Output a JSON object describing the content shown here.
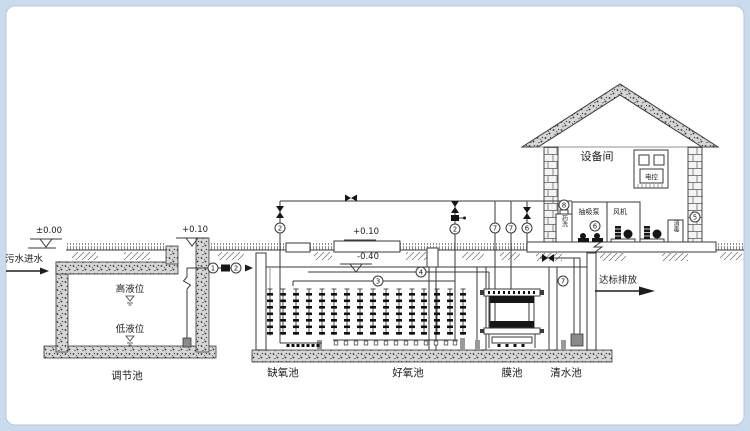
{
  "diagram": {
    "inlet_label": "污水进水",
    "outlet_label": "达标排放",
    "room_label": "设备间",
    "suction_pump_label": "抽吸泵",
    "blower_label": "风机",
    "panel_label": "电控",
    "chem_wash_label": "药洗",
    "disinfect_label": "消毒",
    "high_level_label": "高液位",
    "low_level_label": "低液位"
  },
  "elevations": {
    "ground": "±0.00",
    "reg_wall": "+0.10",
    "tank_curb": "+0.10",
    "water": "-0.40"
  },
  "tanks": [
    {
      "name": "调节池"
    },
    {
      "name": "缺氧池"
    },
    {
      "name": "好氧池"
    },
    {
      "name": "膜池"
    },
    {
      "name": "清水池"
    }
  ],
  "tags": {
    "t1": "1",
    "t2": "2",
    "t3": "2",
    "t4": "3",
    "t5": "4",
    "t6": "2",
    "t7": "7",
    "t8": "7",
    "t9": "6",
    "t10": "8",
    "t11": "6",
    "t12": "5",
    "t13": "7"
  },
  "colors": {
    "frame": "#c9dbec",
    "paper": "#ffffff",
    "line": "#3a3a3a"
  }
}
